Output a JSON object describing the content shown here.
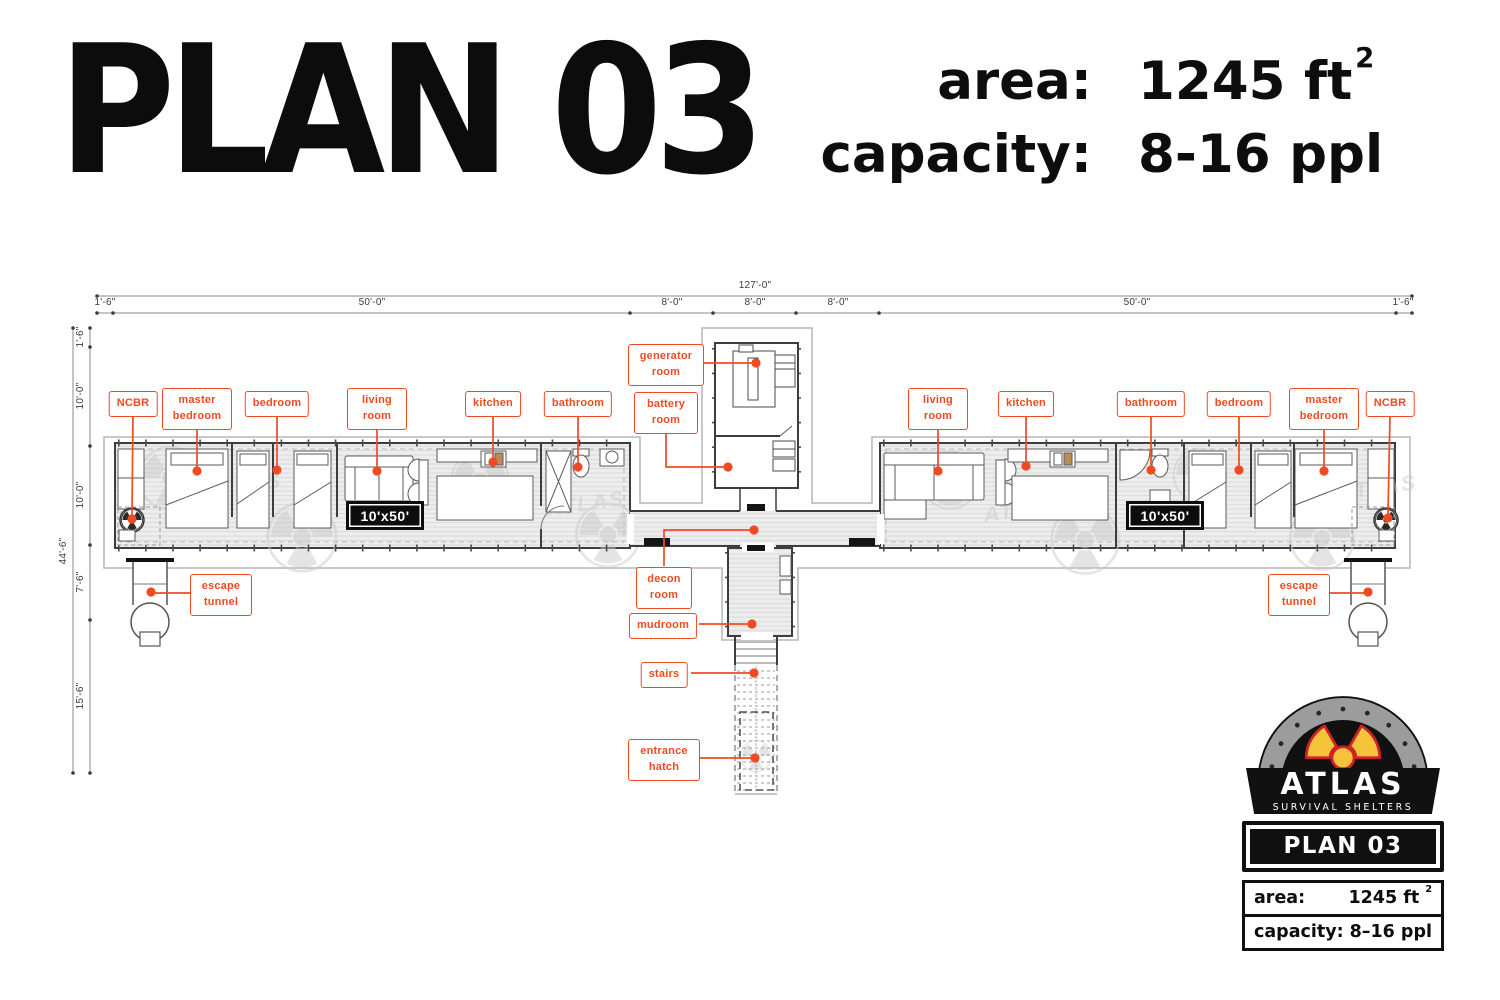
{
  "header": {
    "title": "PLAN 03",
    "area_label": "area:",
    "area_value": "1245 ft",
    "area_sup": "2",
    "capacity_label": "capacity:",
    "capacity_value": "8-16 ppl"
  },
  "plan": {
    "dims": {
      "total_width": "127'-0\"",
      "top_segments": [
        "1'-6\"",
        "50'-0\"",
        "8'-0\"",
        "8'-0\"",
        "8'-0\"",
        "50'-0\"",
        "1'-6\""
      ],
      "left_total": "44'-6\"",
      "left_segments": [
        "1'-6\"",
        "10'-0\"",
        "10'-0\"",
        "7'-6\"",
        "15'-6\""
      ]
    },
    "unit_badge": "10'x50'",
    "watermark": "ATLAS",
    "labels": [
      {
        "id": "ncbr-left",
        "text": "NCBR"
      },
      {
        "id": "master-bedroom-left",
        "text": "master bedroom"
      },
      {
        "id": "bedroom-left",
        "text": "bedroom"
      },
      {
        "id": "living-room-left",
        "text": "living room"
      },
      {
        "id": "kitchen-left",
        "text": "kitchen"
      },
      {
        "id": "bathroom-left",
        "text": "bathroom"
      },
      {
        "id": "generator-room",
        "text": "generator room"
      },
      {
        "id": "battery-room",
        "text": "battery room"
      },
      {
        "id": "living-room-right",
        "text": "living room"
      },
      {
        "id": "kitchen-right",
        "text": "kitchen"
      },
      {
        "id": "bathroom-right",
        "text": "bathroom"
      },
      {
        "id": "bedroom-right",
        "text": "bedroom"
      },
      {
        "id": "master-bedroom-right",
        "text": "master bedroom"
      },
      {
        "id": "ncbr-right",
        "text": "NCBR"
      },
      {
        "id": "escape-tunnel-left",
        "text": "escape tunnel"
      },
      {
        "id": "decon-room",
        "text": "decon room"
      },
      {
        "id": "mudroom",
        "text": "mudroom"
      },
      {
        "id": "stairs",
        "text": "stairs"
      },
      {
        "id": "entrance-hatch",
        "text": "entrance hatch"
      },
      {
        "id": "escape-tunnel-right",
        "text": "escape tunnel"
      }
    ]
  },
  "logo": {
    "brand": "ATLAS",
    "tagline": "SURVIVAL SHELTERS",
    "plan_badge": "PLAN 03",
    "area_label": "area:",
    "area_value": "1245 ft",
    "area_sup": "2",
    "capacity_label": "capacity:",
    "capacity_value": "8–16 ppl"
  },
  "colors": {
    "accent": "#f04a23",
    "ink": "#111111"
  }
}
